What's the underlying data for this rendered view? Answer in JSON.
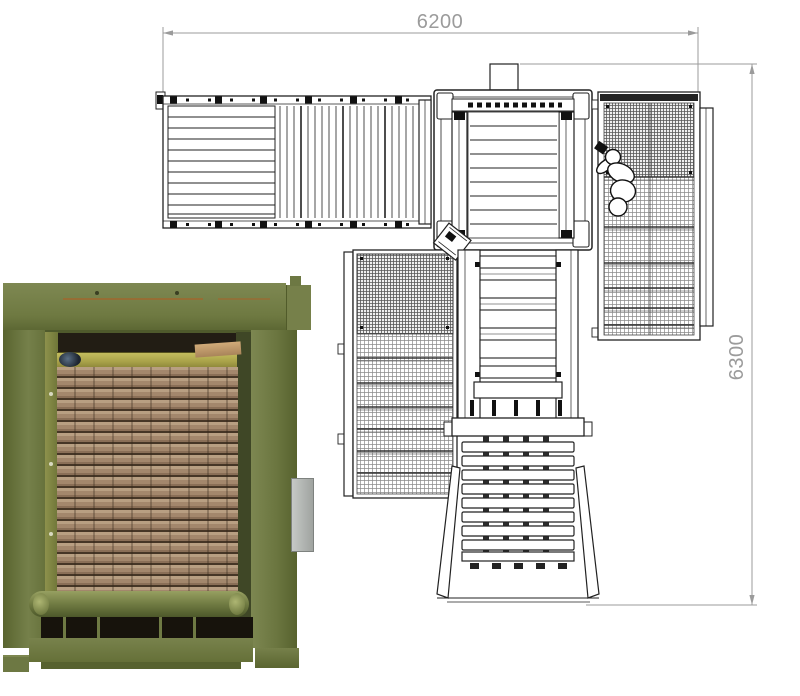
{
  "drawing": {
    "dim_width": "6200",
    "dim_height": "6300",
    "line_color": "#222222",
    "dim_color": "#9b9b9b",
    "mesh_color": "#8a8a8a"
  },
  "photo": {
    "machine_green": "#6e7941",
    "lumber_tan": "#b89f82",
    "platen_yellow": "#b5ae50",
    "opening_dark": "#221d14"
  }
}
